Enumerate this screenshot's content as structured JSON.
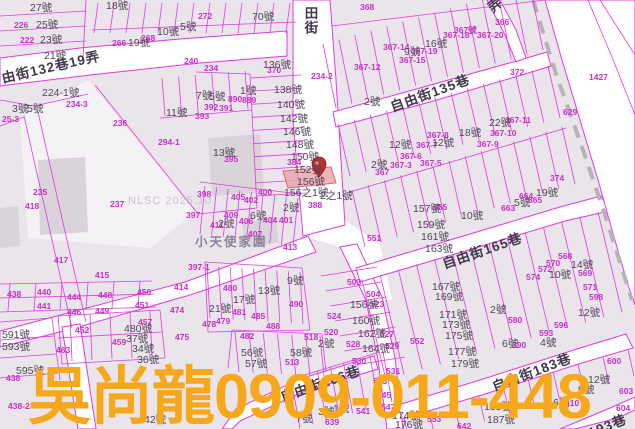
{
  "watermark": {
    "text": "吳尚龍0909-011-448",
    "color": "#f6a71a"
  },
  "map": {
    "nlsc_watermark": "NLSC 2025.10",
    "place_label": "小天使家園",
    "selected_parcel": {
      "highlighted_house_number": "156號",
      "marker": "map-pin"
    },
    "colors": {
      "boundary_line": "#e03adf",
      "parcel_text": "#c92fc9",
      "house_text": "#4f4658",
      "street_text": "#42384c",
      "highlight_fill": "#e9a3a8",
      "road_fill": "#ffffff",
      "block_fill": "#eae5ea"
    },
    "street_labels": [
      [
        "由街132巷19弄",
        2,
        72,
        -13
      ],
      [
        "田街",
        303,
        6,
        0,
        "v"
      ],
      [
        "弄",
        490,
        3,
        -40
      ],
      [
        "自由街135巷",
        391,
        101,
        -20
      ],
      [
        "自由街165巷",
        443,
        258,
        -19
      ],
      [
        "自由街166巷",
        281,
        391,
        -19
      ],
      [
        "自由街183巷",
        493,
        381,
        -21
      ],
      [
        "193巷",
        589,
        427,
        -22
      ]
    ],
    "house_labels": [
      [
        "27號",
        30,
        3
      ],
      [
        "25號",
        36,
        20
      ],
      [
        "23號",
        40,
        35
      ],
      [
        "21號",
        44,
        51
      ],
      [
        "18號",
        106,
        1
      ],
      [
        "10號",
        157,
        27
      ],
      [
        "5號",
        180,
        22
      ],
      [
        "70號",
        252,
        12
      ],
      [
        "19號",
        128,
        38
      ],
      [
        "3號",
        12,
        104
      ],
      [
        "5號",
        27,
        104
      ],
      [
        "224-1號",
        42,
        88
      ],
      [
        "11號",
        166,
        108
      ],
      [
        "7號",
        196,
        91
      ],
      [
        "5號",
        209,
        92
      ],
      [
        "1號",
        240,
        86
      ],
      [
        "13號",
        213,
        148
      ],
      [
        "136號",
        263,
        60
      ],
      [
        "138號",
        274,
        85
      ],
      [
        "140號",
        277,
        100
      ],
      [
        "142號",
        280,
        114
      ],
      [
        "146號",
        283,
        127
      ],
      [
        "148號",
        286,
        140
      ],
      [
        "150號",
        291,
        152
      ],
      [
        "152號",
        294,
        165
      ],
      [
        "156號",
        297,
        177
      ],
      [
        "156之1號",
        284,
        188
      ],
      [
        "2號",
        364,
        97
      ],
      [
        "2之1號",
        320,
        191
      ],
      [
        "22號",
        489,
        118
      ],
      [
        "18號",
        459,
        128
      ],
      [
        "12號",
        432,
        138
      ],
      [
        "16號",
        425,
        39
      ],
      [
        "9號",
        404,
        47
      ],
      [
        "12號",
        389,
        140
      ],
      [
        "2號",
        371,
        160
      ],
      [
        "2號",
        283,
        203
      ],
      [
        "6號",
        250,
        211
      ],
      [
        "2號",
        218,
        219
      ],
      [
        "21號",
        209,
        304
      ],
      [
        "17號",
        233,
        295
      ],
      [
        "13號",
        258,
        286
      ],
      [
        "9號",
        287,
        276
      ],
      [
        "591號",
        2,
        330
      ],
      [
        "593號",
        2,
        342
      ],
      [
        "595號",
        16,
        366
      ],
      [
        "480號",
        124,
        324
      ],
      [
        "37號",
        126,
        334
      ],
      [
        "34號",
        132,
        344
      ],
      [
        "36號",
        137,
        355
      ],
      [
        "56號",
        241,
        348
      ],
      [
        "57號",
        245,
        359
      ],
      [
        "58號",
        290,
        348
      ],
      [
        "2號",
        318,
        339
      ],
      [
        "156號",
        350,
        300
      ],
      [
        "160號",
        352,
        316
      ],
      [
        "162號",
        358,
        329
      ],
      [
        "164號",
        362,
        344
      ],
      [
        "157號",
        413,
        204
      ],
      [
        "159號",
        417,
        220
      ],
      [
        "161號",
        421,
        232
      ],
      [
        "163號",
        425,
        244
      ],
      [
        "167號",
        432,
        282
      ],
      [
        "169號",
        435,
        292
      ],
      [
        "171號",
        439,
        310
      ],
      [
        "173號",
        442,
        320
      ],
      [
        "175號",
        445,
        331
      ],
      [
        "177號",
        448,
        347
      ],
      [
        "179號",
        451,
        359
      ],
      [
        "2號",
        490,
        305
      ],
      [
        "5號",
        514,
        198
      ],
      [
        "10號",
        461,
        211
      ],
      [
        "19號",
        536,
        188
      ],
      [
        "14號",
        571,
        260
      ],
      [
        "10號",
        549,
        270
      ],
      [
        "12號",
        578,
        308
      ],
      [
        "4號",
        540,
        338
      ],
      [
        "6號",
        502,
        339
      ],
      [
        "12號",
        588,
        375
      ],
      [
        "9號",
        578,
        385
      ],
      [
        "6號",
        553,
        398
      ],
      [
        "185號",
        484,
        402
      ],
      [
        "187號",
        487,
        415
      ],
      [
        "174號",
        392,
        411
      ],
      [
        "176號",
        395,
        420
      ],
      [
        "7號",
        296,
        414
      ],
      [
        "3號",
        318,
        407
      ],
      [
        "1號",
        333,
        404
      ],
      [
        "42號",
        144,
        415
      ]
    ],
    "parcel_labels": [
      [
        "226",
        14,
        21
      ],
      [
        "222",
        20,
        36
      ],
      [
        "25-3",
        2,
        115
      ],
      [
        "234-3",
        66,
        100
      ],
      [
        "234-2",
        311,
        72
      ],
      [
        "266",
        112,
        39
      ],
      [
        "268",
        141,
        34
      ],
      [
        "272",
        198,
        12
      ],
      [
        "240",
        184,
        57
      ],
      [
        "234",
        204,
        64
      ],
      [
        "368",
        360,
        3
      ],
      [
        "366",
        495,
        18
      ],
      [
        "372",
        510,
        68
      ],
      [
        "1427",
        589,
        73
      ],
      [
        "629",
        563,
        108
      ],
      [
        "374",
        550,
        174
      ],
      [
        "370",
        267,
        66
      ],
      [
        "384",
        287,
        158
      ],
      [
        "388",
        308,
        201
      ],
      [
        "392",
        204,
        103
      ],
      [
        "391",
        219,
        104
      ],
      [
        "393",
        195,
        112
      ],
      [
        "395",
        224,
        155
      ],
      [
        "294-1",
        158,
        138
      ],
      [
        "890",
        228,
        95
      ],
      [
        "889",
        242,
        96
      ],
      [
        "398",
        197,
        190
      ],
      [
        "397",
        186,
        211
      ],
      [
        "397-1",
        188,
        263
      ],
      [
        "400",
        258,
        188
      ],
      [
        "402",
        244,
        196
      ],
      [
        "405",
        231,
        193
      ],
      [
        "404",
        263,
        216
      ],
      [
        "401",
        279,
        216
      ],
      [
        "406",
        239,
        217
      ],
      [
        "407",
        248,
        230
      ],
      [
        "409",
        224,
        211
      ],
      [
        "411",
        210,
        221
      ],
      [
        "413",
        283,
        243
      ],
      [
        "414",
        174,
        283
      ],
      [
        "415",
        95,
        271
      ],
      [
        "417",
        54,
        256
      ],
      [
        "418",
        25,
        202
      ],
      [
        "235",
        33,
        188
      ],
      [
        "236",
        113,
        119
      ],
      [
        "237",
        110,
        200
      ],
      [
        "438",
        7,
        290
      ],
      [
        "440",
        37,
        288
      ],
      [
        "444",
        67,
        293
      ],
      [
        "448",
        98,
        291
      ],
      [
        "450",
        137,
        288
      ],
      [
        "441",
        37,
        302
      ],
      [
        "446",
        67,
        308
      ],
      [
        "449",
        95,
        307
      ],
      [
        "451",
        135,
        301
      ],
      [
        "474",
        170,
        306
      ],
      [
        "452",
        75,
        326
      ],
      [
        "457",
        138,
        318
      ],
      [
        "459",
        112,
        338
      ],
      [
        "463",
        56,
        346
      ],
      [
        "480",
        223,
        284
      ],
      [
        "481",
        232,
        308
      ],
      [
        "478",
        202,
        320
      ],
      [
        "479",
        216,
        317
      ],
      [
        "485",
        251,
        312
      ],
      [
        "488",
        266,
        322
      ],
      [
        "490",
        289,
        300
      ],
      [
        "475",
        175,
        333
      ],
      [
        "482",
        240,
        332
      ],
      [
        "513",
        285,
        358
      ],
      [
        "518",
        304,
        333
      ],
      [
        "524",
        327,
        312
      ],
      [
        "520",
        324,
        328
      ],
      [
        "523",
        370,
        300
      ],
      [
        "527",
        380,
        330
      ],
      [
        "528",
        346,
        340
      ],
      [
        "529",
        385,
        342
      ],
      [
        "530",
        352,
        357
      ],
      [
        "531",
        386,
        367
      ],
      [
        "503",
        347,
        278
      ],
      [
        "504",
        366,
        290
      ],
      [
        "551",
        367,
        234
      ],
      [
        "552",
        410,
        337
      ],
      [
        "555",
        433,
        203
      ],
      [
        "543",
        373,
        377
      ],
      [
        "545",
        377,
        391
      ],
      [
        "547",
        381,
        403
      ],
      [
        "541",
        356,
        407
      ],
      [
        "639",
        325,
        418
      ],
      [
        "553",
        427,
        415
      ],
      [
        "642",
        457,
        422
      ],
      [
        "568",
        558,
        252
      ],
      [
        "570",
        546,
        259
      ],
      [
        "572",
        538,
        265
      ],
      [
        "574",
        526,
        273
      ],
      [
        "569",
        578,
        269
      ],
      [
        "571",
        583,
        283
      ],
      [
        "598",
        589,
        293
      ],
      [
        "580",
        508,
        316
      ],
      [
        "590",
        512,
        341
      ],
      [
        "593",
        539,
        329
      ],
      [
        "596",
        554,
        321
      ],
      [
        "600",
        607,
        357
      ],
      [
        "603",
        619,
        387
      ],
      [
        "604",
        616,
        404
      ],
      [
        "610",
        565,
        399
      ],
      [
        "663",
        501,
        204
      ],
      [
        "664",
        519,
        192
      ],
      [
        "665",
        528,
        196
      ],
      [
        "438-2",
        8,
        402
      ],
      [
        "438",
        6,
        374
      ],
      [
        "367-14",
        383,
        43
      ],
      [
        "367-18",
        443,
        31
      ],
      [
        "367號",
        454,
        26
      ],
      [
        "367-20",
        477,
        31
      ],
      [
        "367-19",
        411,
        47
      ],
      [
        "367-15",
        399,
        56
      ],
      [
        "367-12",
        354,
        63
      ],
      [
        "367-11",
        505,
        116
      ],
      [
        "367-10",
        490,
        129
      ],
      [
        "367-9",
        477,
        140
      ],
      [
        "367-7",
        416,
        141
      ],
      [
        "367-8",
        427,
        131
      ],
      [
        "367-3",
        390,
        161
      ],
      [
        "367-5",
        420,
        159
      ],
      [
        "367-6",
        400,
        152
      ],
      [
        "367",
        375,
        168
      ]
    ]
  }
}
